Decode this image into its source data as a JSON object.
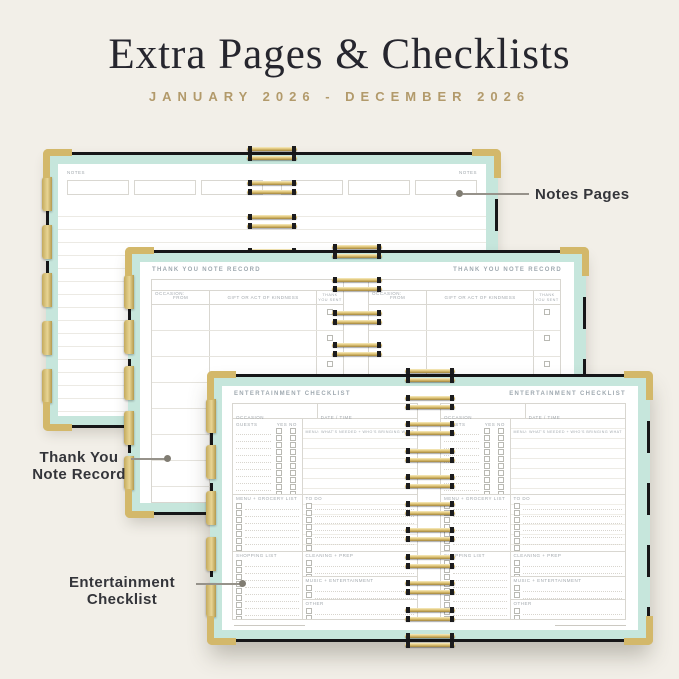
{
  "header": {
    "title": "Extra Pages & Checklists",
    "subtitle": "JANUARY 2026 - DECEMBER 2026"
  },
  "callouts": {
    "notes": "Notes Pages",
    "thank_you": [
      "Thank You",
      "Note Record"
    ],
    "entertainment": [
      "Entertainment",
      "Checklist"
    ]
  },
  "notes_page": {
    "corner_label": "NOTES"
  },
  "thank_you_page": {
    "title": "THANK YOU NOTE RECORD",
    "occasion": "OCCASION:",
    "col_from": "FROM",
    "col_gift": "GIFT OR ACT OF KINDNESS",
    "col_sent": "THANK YOU SENT"
  },
  "entertainment_page": {
    "title": "ENTERTAINMENT CHECKLIST",
    "occasion": "OCCASION",
    "datetime": "DATE / TIME",
    "guests": "GUESTS",
    "yes": "YES",
    "no": "NO",
    "menu_note": "MENU: WHAT'S NEEDED + WHO'S BRINGING WHAT",
    "sec_menu": "MENU + GROCERY LIST",
    "sec_todo": "TO DO",
    "sec_shopping": "SHOPPING LIST",
    "sec_cleaning": "CLEANING + PREP",
    "sec_music": "MUSIC + ENTERTAINMENT",
    "sec_other": "OTHER"
  },
  "colors": {
    "background_cream": "#f2efe8",
    "title_ink": "#26262e",
    "subtitle_gold": "#b29a6b",
    "cover_black": "#161618",
    "trim_mint": "#c6e6dc",
    "hardware_gold": "#d3b86a",
    "page_rule_grey": "#eceae4",
    "callout_ink": "#34353a"
  },
  "repeat": {
    "note_boxes": 3,
    "coil_loops": 9,
    "coil_loops_tall": 11,
    "side_tabs": 5,
    "thank_you_rows": 9,
    "guest_rows": 10,
    "menu_rows": 7,
    "todo_rows": 7,
    "shopping_rows": 9,
    "cleaning_rows": 3,
    "music_rows": 2,
    "other_rows": 2
  }
}
